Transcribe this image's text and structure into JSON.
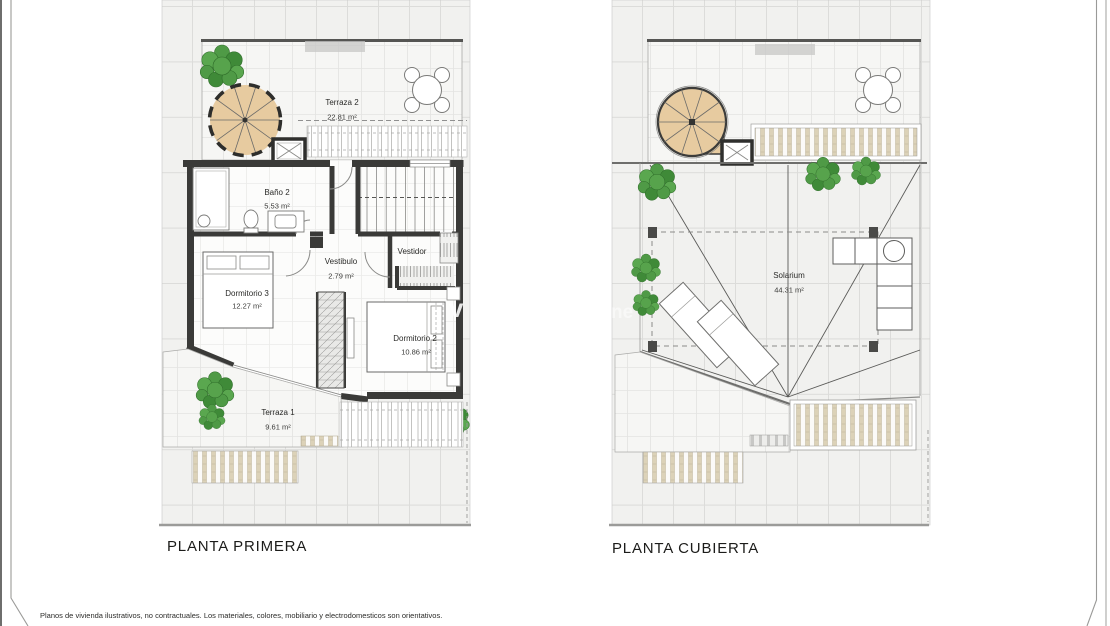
{
  "sheet": {
    "disclaimer": "Planos de vivienda ilustrativos, no contractuales. Los materiales, colores, mobiliario y electrodomesticos son orientativos."
  },
  "plans": {
    "left": {
      "title": "PLANTA PRIMERA",
      "rooms": {
        "terraza2": {
          "name": "Terraza 2",
          "area": "22.81 m²"
        },
        "bano2": {
          "name": "Baño 2",
          "area": "5.53 m²"
        },
        "vestibulo": {
          "name": "Vestibulo",
          "area": "2.79 m²"
        },
        "vestidor": {
          "name": "Vestidor"
        },
        "dormitorio3": {
          "name": "Dormitorio 3",
          "area": "12.27 m²"
        },
        "dormitorio2": {
          "name": "Dormitorio 2",
          "area": "10.86 m²"
        },
        "terraza1": {
          "name": "Terraza 1",
          "area": "9.61 m²"
        }
      }
    },
    "right": {
      "title": "PLANTA CUBIERTA",
      "rooms": {
        "solarium": {
          "name": "Solarium",
          "area": "44.31 m²"
        }
      }
    }
  },
  "watermark": {
    "fragment_left": "v",
    "fragment_right": "ne"
  },
  "colors": {
    "wall": "#3a3a38",
    "stair_wood": "#e7cba0",
    "slat_tan": "#dcd2b8",
    "plant_green": "#4f9a46",
    "tile_bg": "#f1f1ef",
    "tile_line": "#dcdcda"
  }
}
